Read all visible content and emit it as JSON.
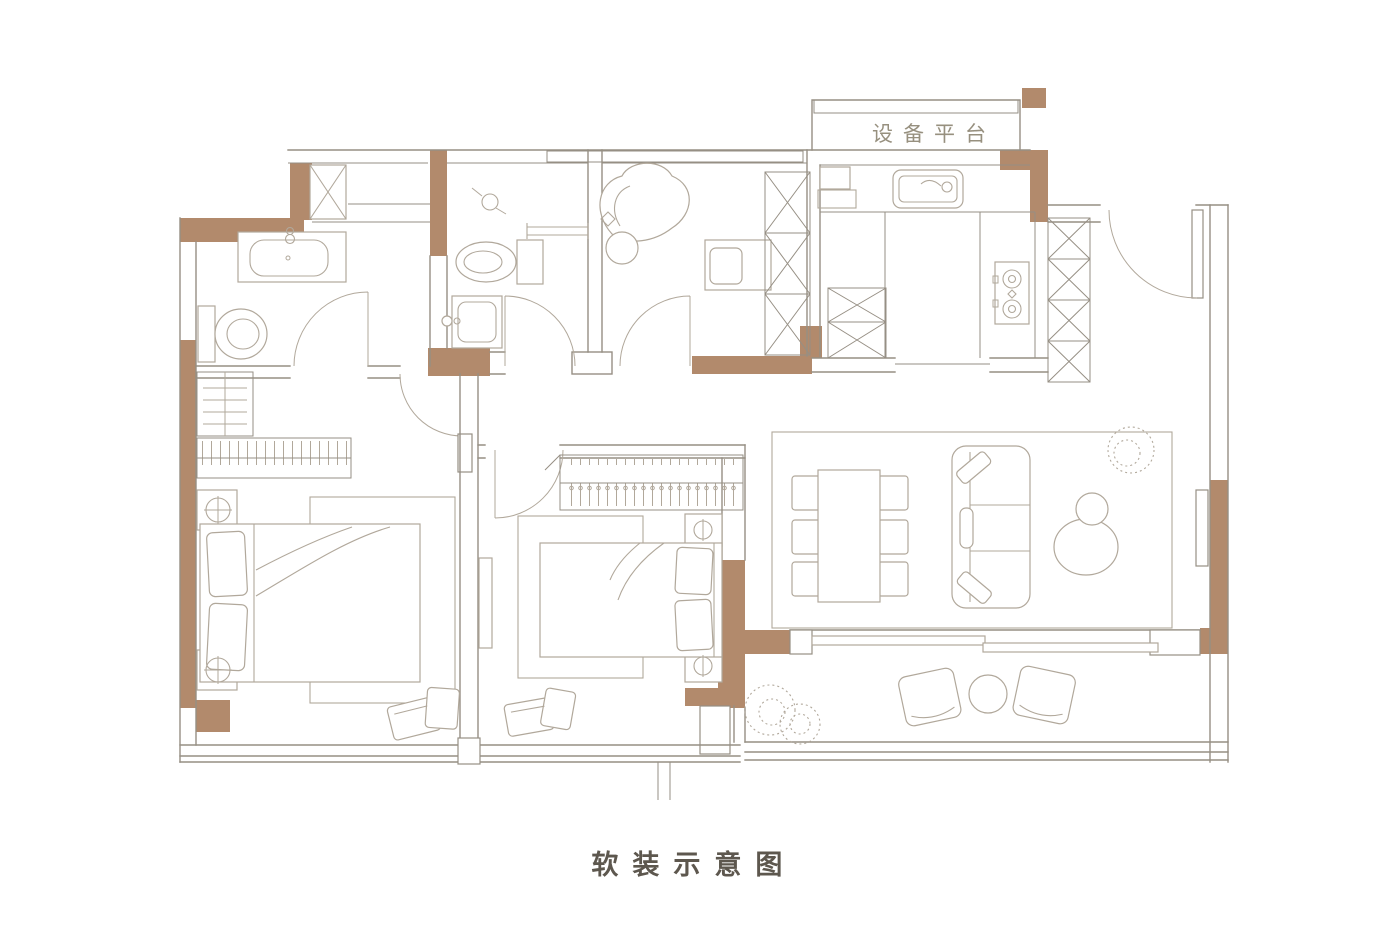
{
  "figure": {
    "platform_label": "设备平台",
    "caption": "软装示意图"
  },
  "colors": {
    "bg": "#ffffff",
    "line": "#968f84",
    "furn": "#b1a89b",
    "wall": "#b28a6c",
    "label": "#97907f",
    "caption": "#5d574e"
  },
  "fixtures": {
    "equipment_platform": [
      "hatched-vent-band"
    ],
    "laundry_nook": [
      "washing-machine"
    ],
    "bathroom_1": [
      "vanity-sink",
      "toilet"
    ],
    "bathroom_2": [
      "shower-head",
      "toilet",
      "towel-bar",
      "wash-basin"
    ],
    "study": [
      "lounge-chair",
      "ottoman",
      "desk",
      "desk-chair",
      "storage-cabinet"
    ],
    "kitchen": [
      "counter",
      "kitchen-sink",
      "cooktop-2-burner",
      "base-cabinets",
      "tall-cabinet"
    ],
    "entry": [
      "entry-door",
      "hall-cabinet"
    ],
    "living_dining": [
      "dining-table-6-chairs",
      "sofa",
      "coffee-tables",
      "plant"
    ],
    "bedroom_1": [
      "shelf-unit",
      "wardrobe-rail",
      "nightstand-lamp",
      "double-bed",
      "rug",
      "lounge-chair"
    ],
    "bedroom_2": [
      "wardrobe-rail",
      "nightstand-lamp",
      "double-bed",
      "rug",
      "chair"
    ],
    "balcony": [
      "plants",
      "armchair",
      "round-table",
      "armchair"
    ]
  }
}
